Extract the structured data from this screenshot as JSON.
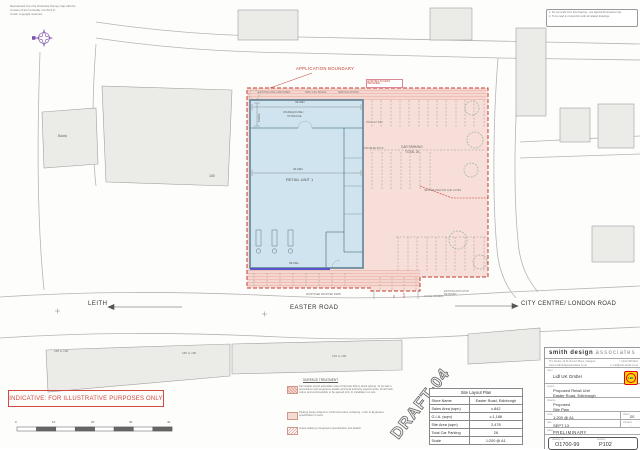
{
  "copyright": {
    "l1": "Reproduced from the Ordnance Survey map with the",
    "l2": "consent of the Controller of H.M.S.O.",
    "l3": "Crown copyright reserved."
  },
  "notes_box": {
    "l1": "1. Do not scale from this drawing - use figured dimensions only.",
    "l2": "2. To be read in conjunction with all related drawings."
  },
  "roads": {
    "leith": "LEITH",
    "easter": "EASTER ROAD",
    "city": "CITY CENTRE/ LONDON ROAD"
  },
  "buildings": {
    "bank": "Bank",
    "n180": "180",
    "row1": "188 to 196",
    "row2": "180 to 186",
    "row3": "156 to 168"
  },
  "site": {
    "boundary_label": "APPLICATION BOUNDARY",
    "retail_unit": "RETAIL UNIT 1",
    "warehouse_l1": "WAREHOUSE /",
    "warehouse_l2": "STORAGE",
    "dim_top": "39.09m",
    "dim_mid": "31.09m",
    "dim_bottom": "39.09m",
    "dim_left": "5.00m",
    "carpark_l1": "CAR PARKING",
    "carpark_l2": "TOTAL 26",
    "ann_access": "EXISTING ACCESS RETAINED",
    "ann_wall": "EXISTING WALL RETAINED",
    "ann_fence": "NEW 1.8m FENCE",
    "ann_service": "SERVICE DOORS",
    "ann_trolley": "TROLLEY BAY",
    "ann_disabled": "DISABLED BAYS",
    "ann_secure": "SECURE FENCING AND GATES",
    "ann_cycle": "CYCLE STANDS",
    "ann_kerb": "PROPOSED DROPPED KERB",
    "ann_bus": "EXISTING BUS STOP RETAINED",
    "ann_in": "IN",
    "ann_out": "OUT"
  },
  "legend": {
    "heading": "SURFACE TREATMENT",
    "item1": "Permeable paved adoptable area (Charcoal) 60mm block paving. To be laid in accordance with engineers details and local authority requirements. Final finish, colour and workmanship to be agreed prior to installation on site.",
    "item2": "Parking areas subject to confirmed colour surfacing - refer to Engineers specification if used.",
    "item3": "Areas relating to Engineers specification and details."
  },
  "indicative": "INDICATIVE: FOR ILLUSTRATIVE PURPOSES ONLY",
  "scalebar": {
    "t0": "0",
    "t1": "10",
    "t2": "20",
    "t3": "30",
    "t4": "40"
  },
  "draft": "DRAFT-04",
  "table": {
    "title": "Site Layout Plan",
    "r1l": "Store Name",
    "r1v": "Easter Road, Edinburgh",
    "r2l": "Sales Area (sqm)",
    "r2v": "c.842",
    "r3l": "G.I.A. (sqm)",
    "r3v": "c.1,186",
    "r4l": "Site Area (sqm)",
    "r4v": "2,478",
    "r5l": "Total Car Parking",
    "r5v": "26",
    "r6l": "Scale",
    "r6v": "1:200 @ A1"
  },
  "titleblock": {
    "firm": "smith design",
    "firm2": "associates",
    "addr1": "The Studio, 24 St Vincent Place, Glasgow",
    "addr2": "www.smithdesignassociates.co.uk",
    "tel": "t. 0141 248 6421",
    "email": "e. mail@sda-studio.co.uk",
    "client_label": "client",
    "client": "Lidl UK GmbH",
    "lidl": "LIDL",
    "project_label": "project",
    "project1": "Proposed Retail Unit",
    "project2": "Easter Road, Edinburgh",
    "drawing_label": "drawing",
    "drawing1": "Proposed",
    "drawing2": "Site Plan",
    "scale_label": "scale",
    "scale": "1:200 @ A1",
    "drawn_label": "drawn",
    "drawn": "DS",
    "date_label": "date",
    "date": "SEPT 13",
    "checked_label": "checked",
    "checked": "-",
    "status_label": "status",
    "status": "PRELIMINARY",
    "dwgno_label": "drawing no",
    "dwgno": "O1700-99",
    "rev_label": "revision",
    "rev": "P102"
  },
  "colors": {
    "boundary_red": "#c0392b",
    "site_pink": "#f8ded8",
    "building_blue": "#cfe4ee",
    "north_purple": "#7b4fae",
    "lidl_yellow": "#ffd800",
    "lidl_red": "#e3000f",
    "lidl_blue": "#0050aa"
  }
}
